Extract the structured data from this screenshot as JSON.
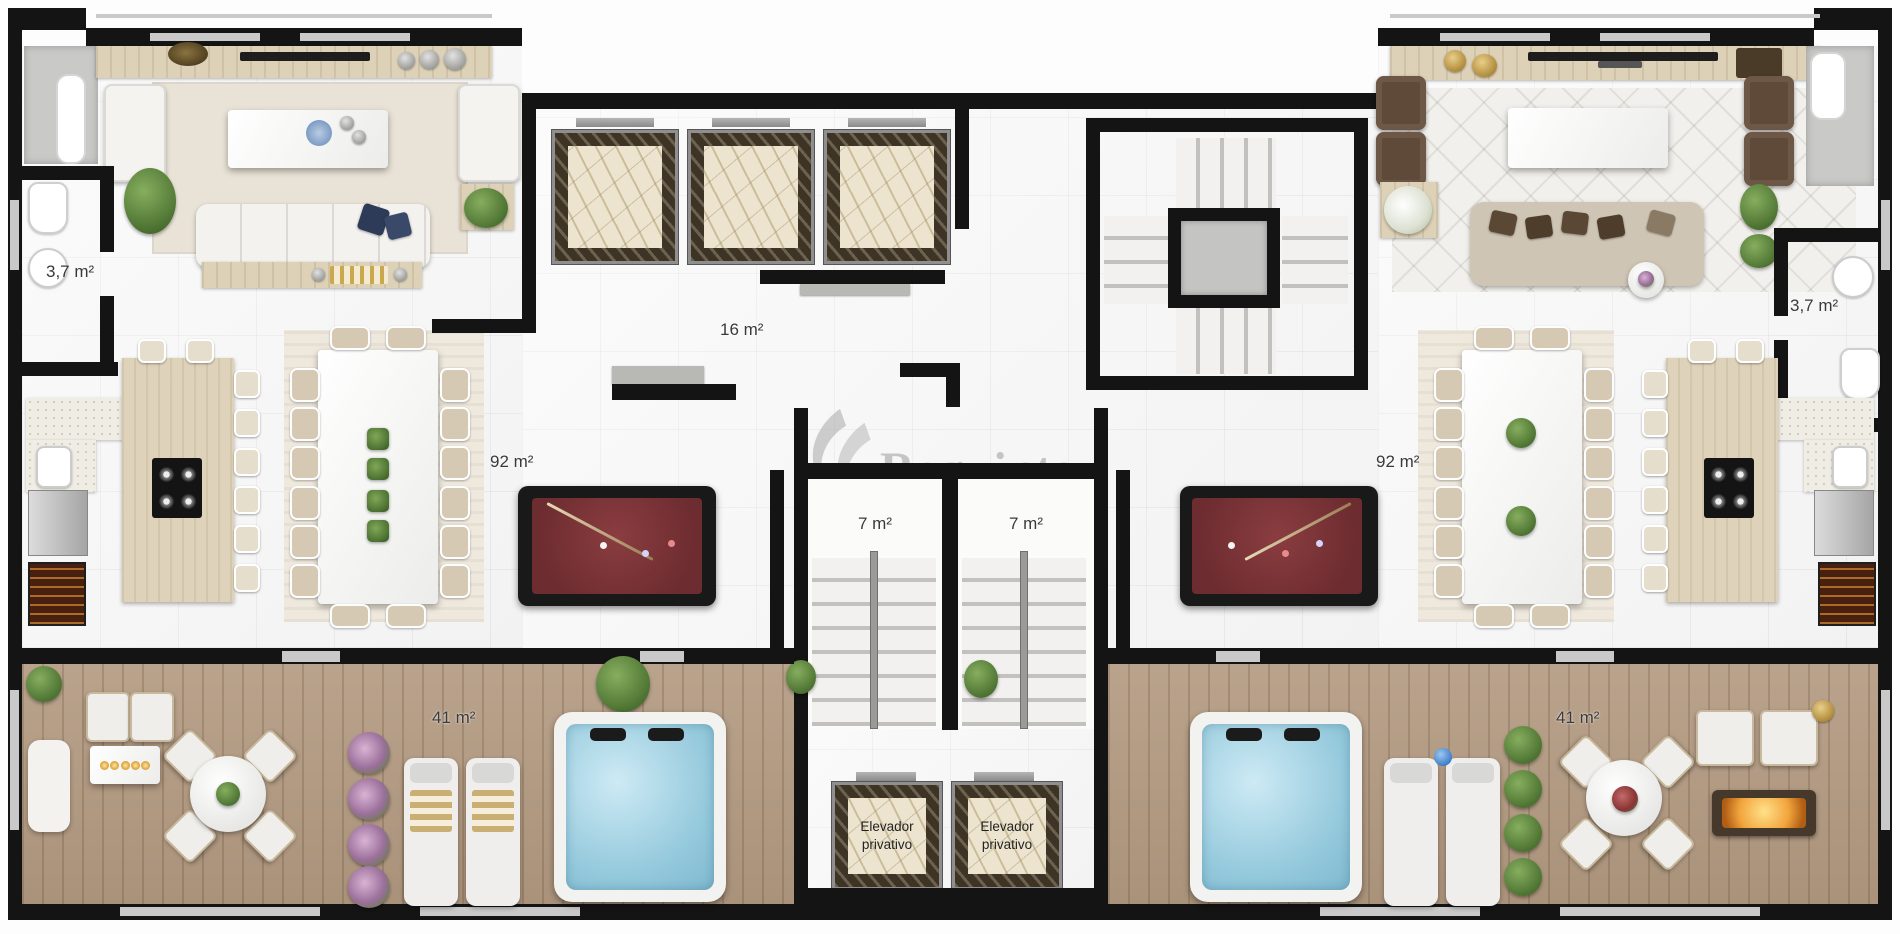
{
  "watermark": {
    "text": "Requinte"
  },
  "labels": {
    "hall": "16 m²",
    "bath_left": "3,7 m²",
    "bath_right": "3,7 m²",
    "living_left": "92 m²",
    "living_right": "92 m²",
    "stair_left": "7 m²",
    "stair_right": "7 m²",
    "terrace_left": "41 m²",
    "terrace_right": "41 m²",
    "private_elevator_left": "Elevador\nprivativo",
    "private_elevator_right": "Elevador\nprivativo"
  },
  "colors": {
    "wall": "#141414",
    "marble_floor": "#f8f8f8",
    "wood_deck": "#b49b82",
    "pool_table_felt": "#7a3336",
    "hot_tub_water": "#a9d8e8",
    "elevator_marble_dark": "#3d3426",
    "elevator_marble_cream": "#ece4cf",
    "plant_green": "#5d8a3c",
    "watermark_gray": "#8a8a8a"
  }
}
